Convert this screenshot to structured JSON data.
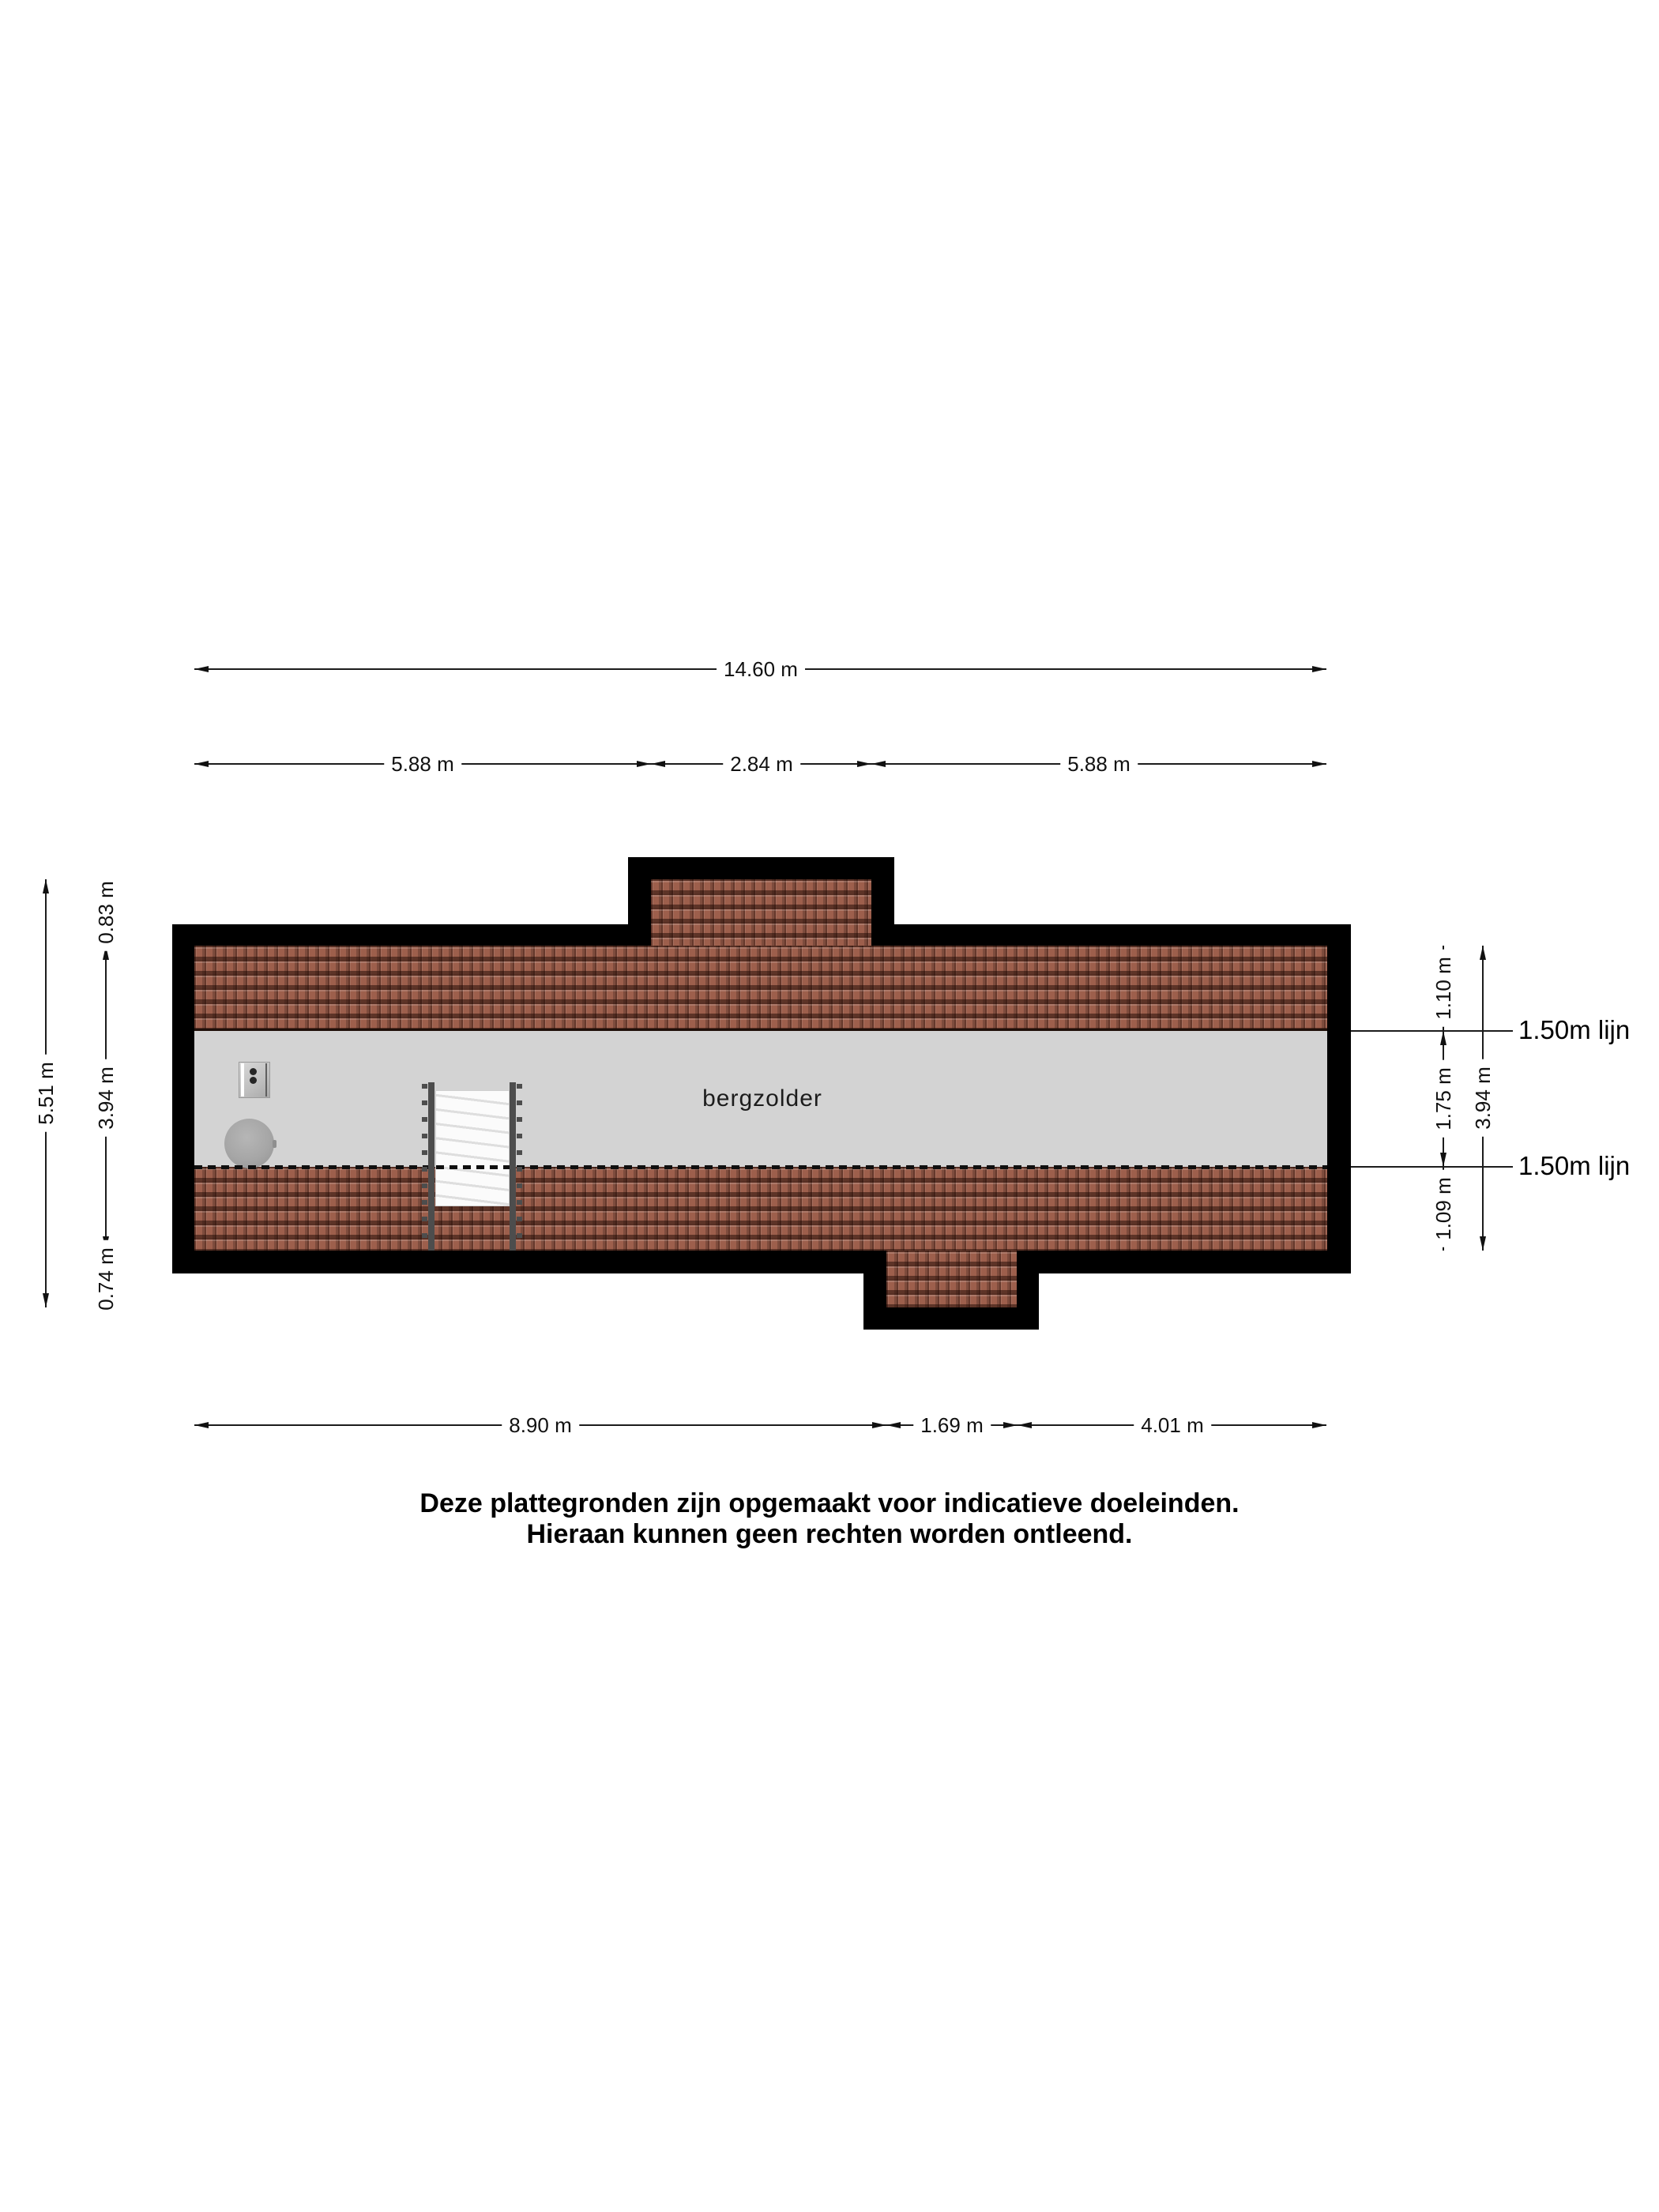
{
  "room": {
    "label": "bergzolder"
  },
  "dimensions": {
    "top_total": "14.60 m",
    "top_segments": [
      "5.88 m",
      "2.84 m",
      "5.88 m"
    ],
    "bottom_segments": [
      "8.90 m",
      "1.69 m",
      "4.01 m"
    ],
    "left_total": "5.51 m",
    "left_segments": [
      "0.83 m",
      "3.94 m",
      "0.74 m"
    ],
    "right_total": "3.94 m",
    "right_segments": [
      "1.10 m",
      "1.75 m",
      "1.09 m"
    ],
    "line150_top": "1.50m lijn",
    "line150_bottom": "1.50m lijn"
  },
  "disclaimer": {
    "line1": "Deze plattegronden zijn opgemaakt voor indicatieve doeleinden.",
    "line2": "Hieraan kunnen geen rechten worden ontleend."
  },
  "colors": {
    "wall": "#000000",
    "roof_tile": "#9d5f4c",
    "floor": "#d3d3d3",
    "dim_line": "#1c1c1c",
    "page_bg": "#ffffff"
  }
}
